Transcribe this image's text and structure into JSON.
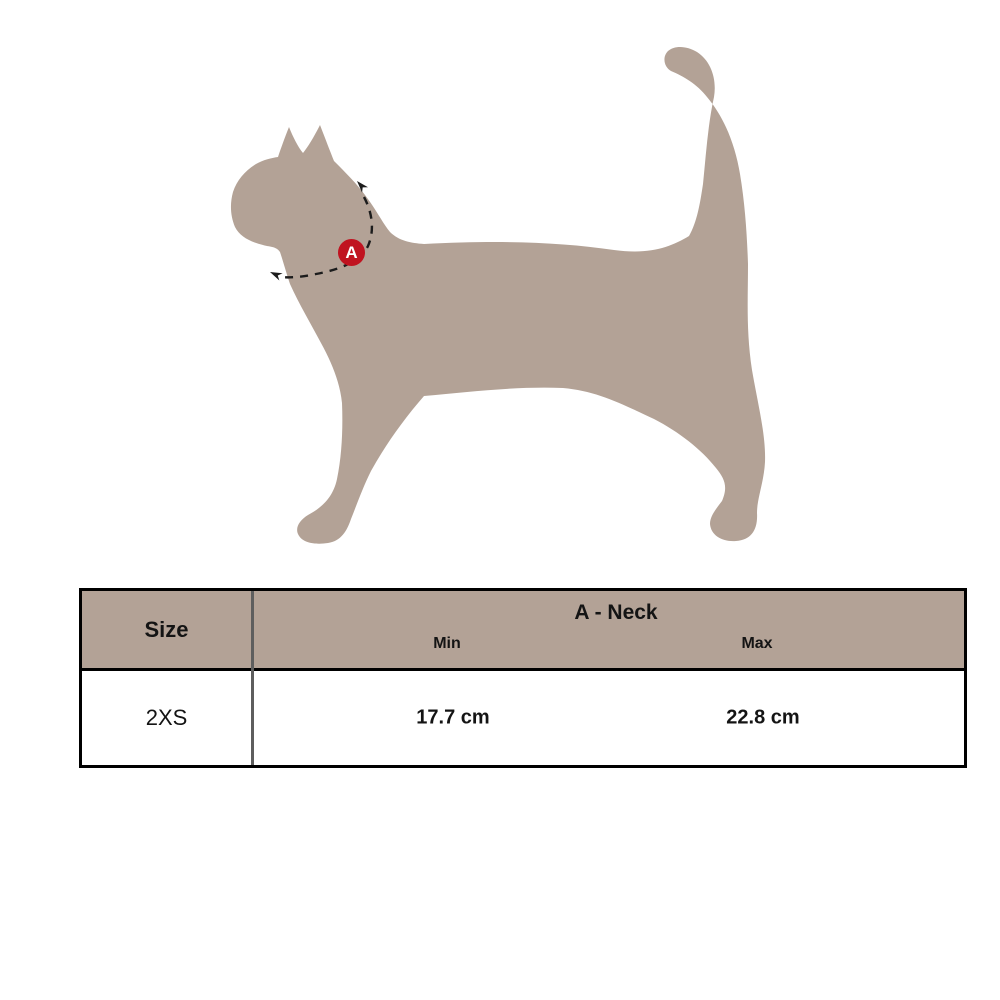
{
  "colors": {
    "silhouette": "#b3a296",
    "table_header_bg": "#b3a296",
    "marker_red": "#c01320",
    "measure_line": "#1c1c1c",
    "table_border": "#000000",
    "column_divider": "#5e5e5e",
    "text": "#141414"
  },
  "diagram": {
    "badge_label": "A"
  },
  "size_table": {
    "size_header": "Size",
    "measure_header": "A - Neck",
    "sub_headers": {
      "min": "Min",
      "max": "Max"
    },
    "rows": [
      {
        "size": "2XS",
        "min": "17.7 cm",
        "max": "22.8 cm"
      }
    ]
  }
}
